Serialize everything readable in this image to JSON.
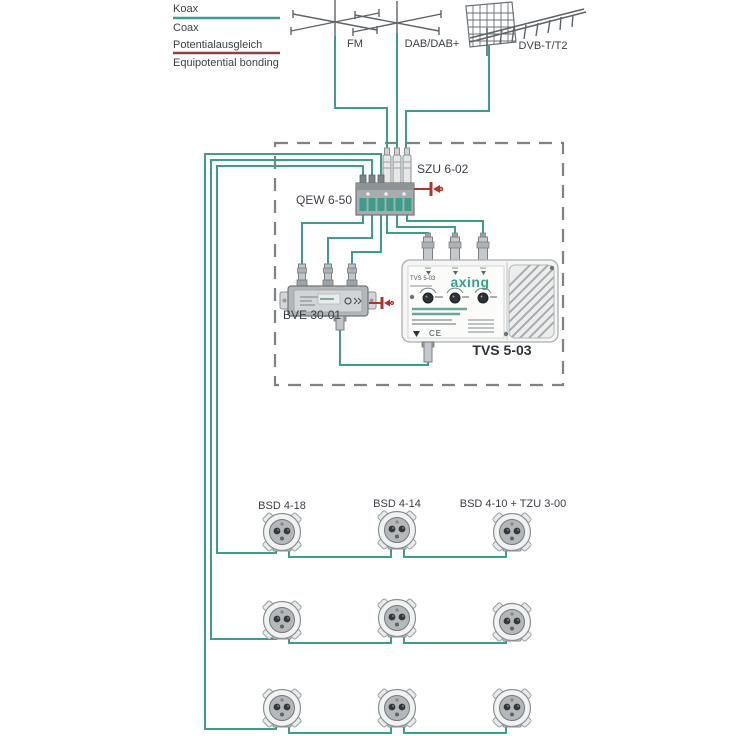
{
  "colors": {
    "coax": "#3d9d8b",
    "bonding_line": "#8a4343",
    "bonding_symbol": "#ad352c",
    "brand": "#36a18d"
  },
  "legend": {
    "koax": "Koax",
    "coax": "Coax",
    "potentialausgleich": "Potentialausgleich",
    "equipotential": "Equipotential bonding"
  },
  "antennas": {
    "fm": "FM",
    "dab": "DAB/DAB+",
    "dvbt": "DVB-T/T2"
  },
  "components": {
    "surge_protector": "SZU 6-02",
    "earth_rail": "QEW 6-50",
    "distributor": "BVE 30-01",
    "amplifier": "TVS 5-03",
    "amplifier_brand": "axing",
    "amplifier_sticker": "TVS 5-03",
    "ce_mark": "CE"
  },
  "outlets": {
    "row1": [
      "BSD 4-18",
      "BSD 4-14",
      "BSD 4-10 + TZU 3-00"
    ]
  }
}
